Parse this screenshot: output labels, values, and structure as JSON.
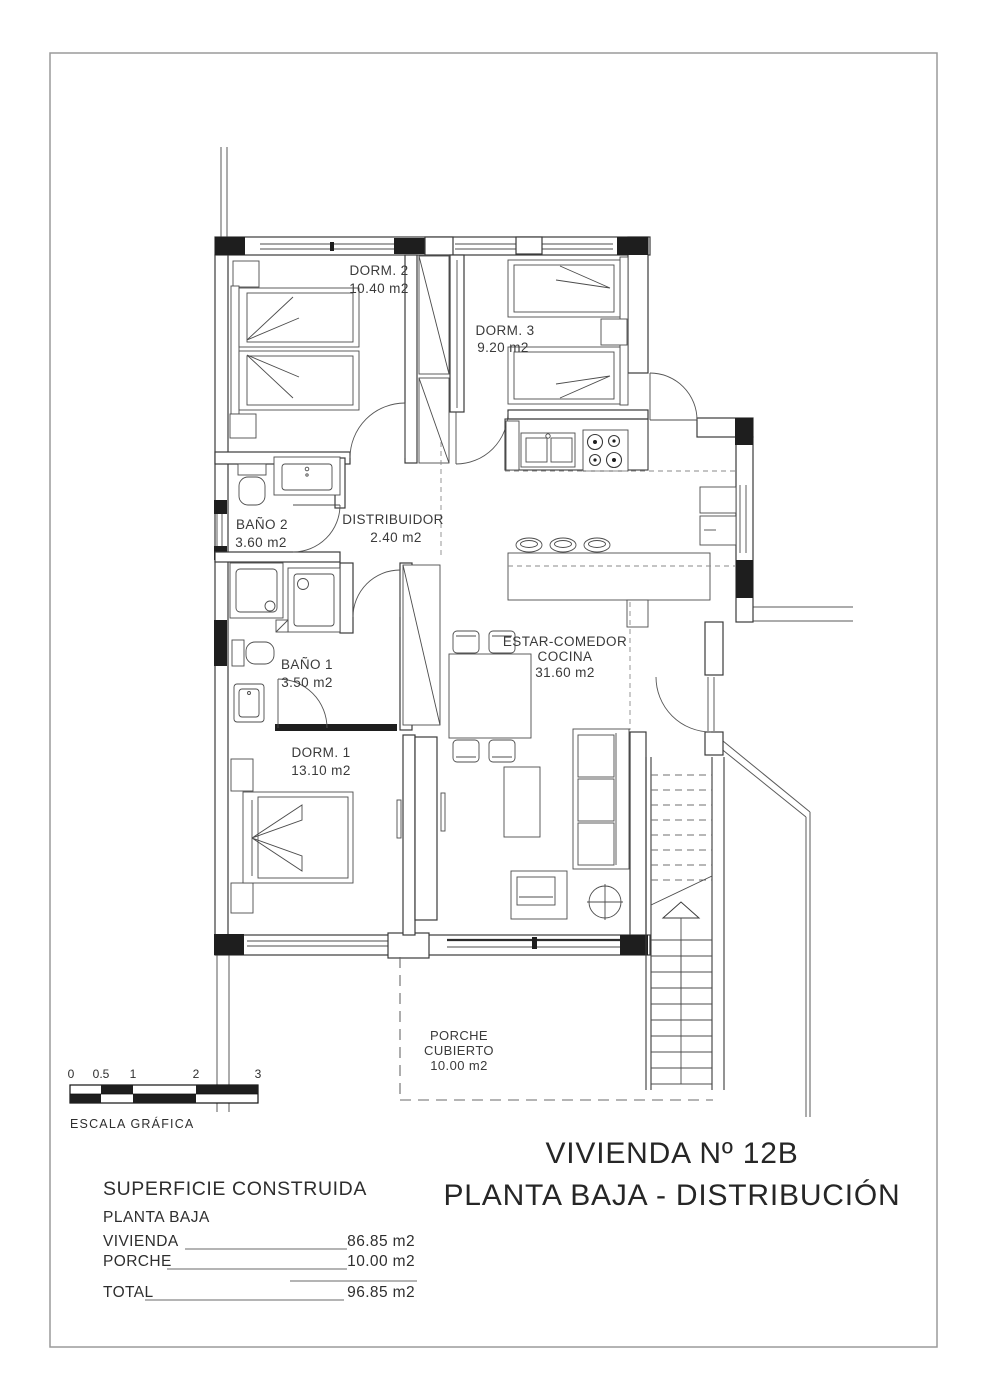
{
  "title": {
    "line1": "VIVIENDA Nº 12B",
    "line2": "PLANTA BAJA - DISTRIBUCIÓN"
  },
  "rooms": {
    "dorm2": {
      "name": "DORM. 2",
      "area": "10.40 m2"
    },
    "dorm3": {
      "name": "DORM. 3",
      "area": "9.20 m2"
    },
    "bano2": {
      "name": "BAÑO 2",
      "area": "3.60 m2"
    },
    "distribuidor": {
      "name": "DISTRIBUIDOR",
      "area": "2.40 m2"
    },
    "bano1": {
      "name": "BAÑO 1",
      "area": "3.50 m2"
    },
    "dorm1": {
      "name": "DORM. 1",
      "area": "13.10 m2"
    },
    "estar": {
      "name_line1": "ESTAR-COMEDOR",
      "name_line2": "COCINA",
      "area": "31.60 m2"
    },
    "porche": {
      "name_line1": "PORCHE",
      "name_line2": "CUBIERTO",
      "area": "10.00 m2"
    }
  },
  "scale_bar": {
    "label": "ESCALA GRÁFICA",
    "ticks": [
      "0",
      "0.5",
      "1",
      "2",
      "3"
    ]
  },
  "summary": {
    "heading": "SUPERFICIE CONSTRUIDA",
    "subheading": "PLANTA BAJA",
    "rows": [
      {
        "label": "VIVIENDA",
        "value": "86.85 m2"
      },
      {
        "label": "PORCHE",
        "value": "10.00 m2"
      }
    ],
    "total": {
      "label": "TOTAL",
      "value": "96.85 m2"
    }
  },
  "colors": {
    "line": "#3b3b3b",
    "sheet_border": "#9a9a9a",
    "background": "#ffffff"
  }
}
